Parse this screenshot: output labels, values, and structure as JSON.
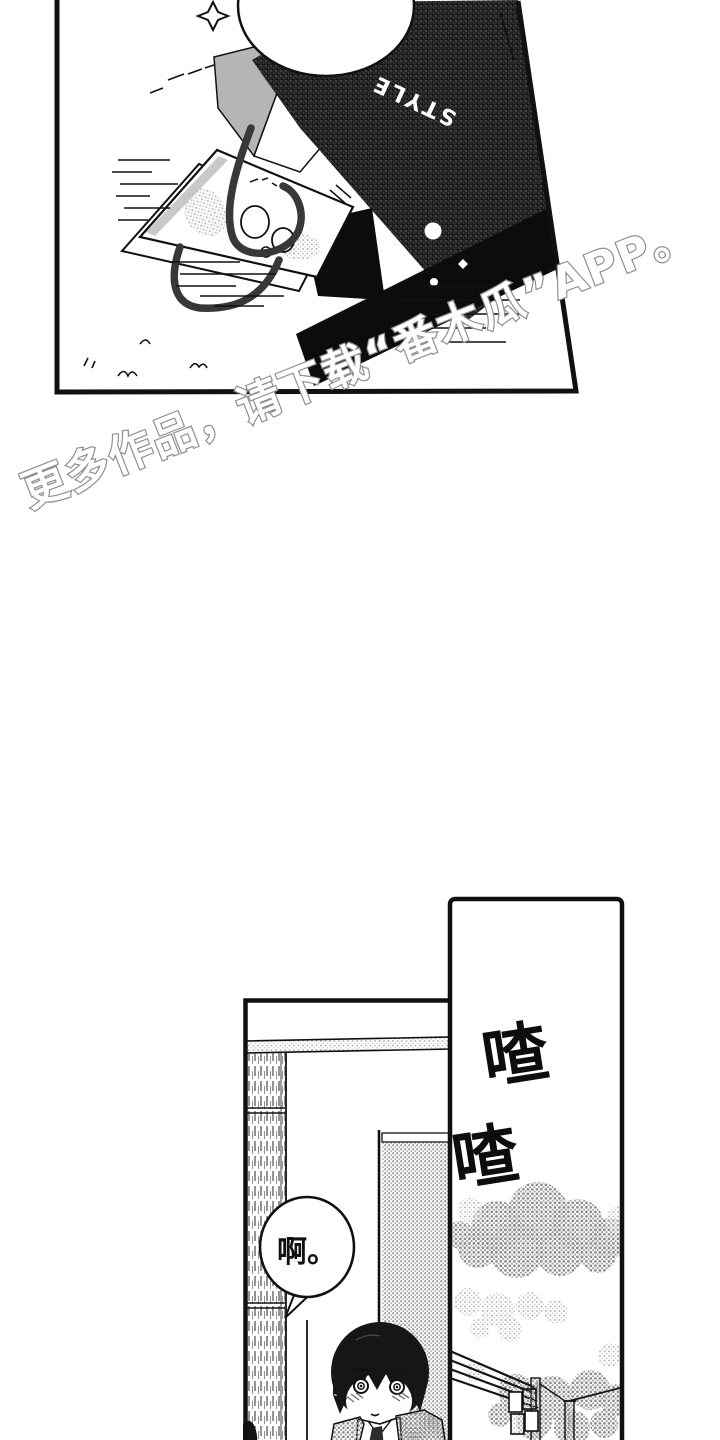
{
  "page": {
    "background": "#ffffff",
    "ink_color": "#111111"
  },
  "watermark": {
    "text": "更多作品，请下载“番木瓜”APP。",
    "fill": "#ffffff",
    "outline": "#8f8f8f",
    "rotation_deg": -21.5
  },
  "panel_top": {
    "bag_brand": "STYLE"
  },
  "panel_bottom_left": {
    "speech_bubble_text": "啊。"
  },
  "panel_bottom_right": {
    "sfx_lines": [
      "喳",
      "喳"
    ]
  }
}
